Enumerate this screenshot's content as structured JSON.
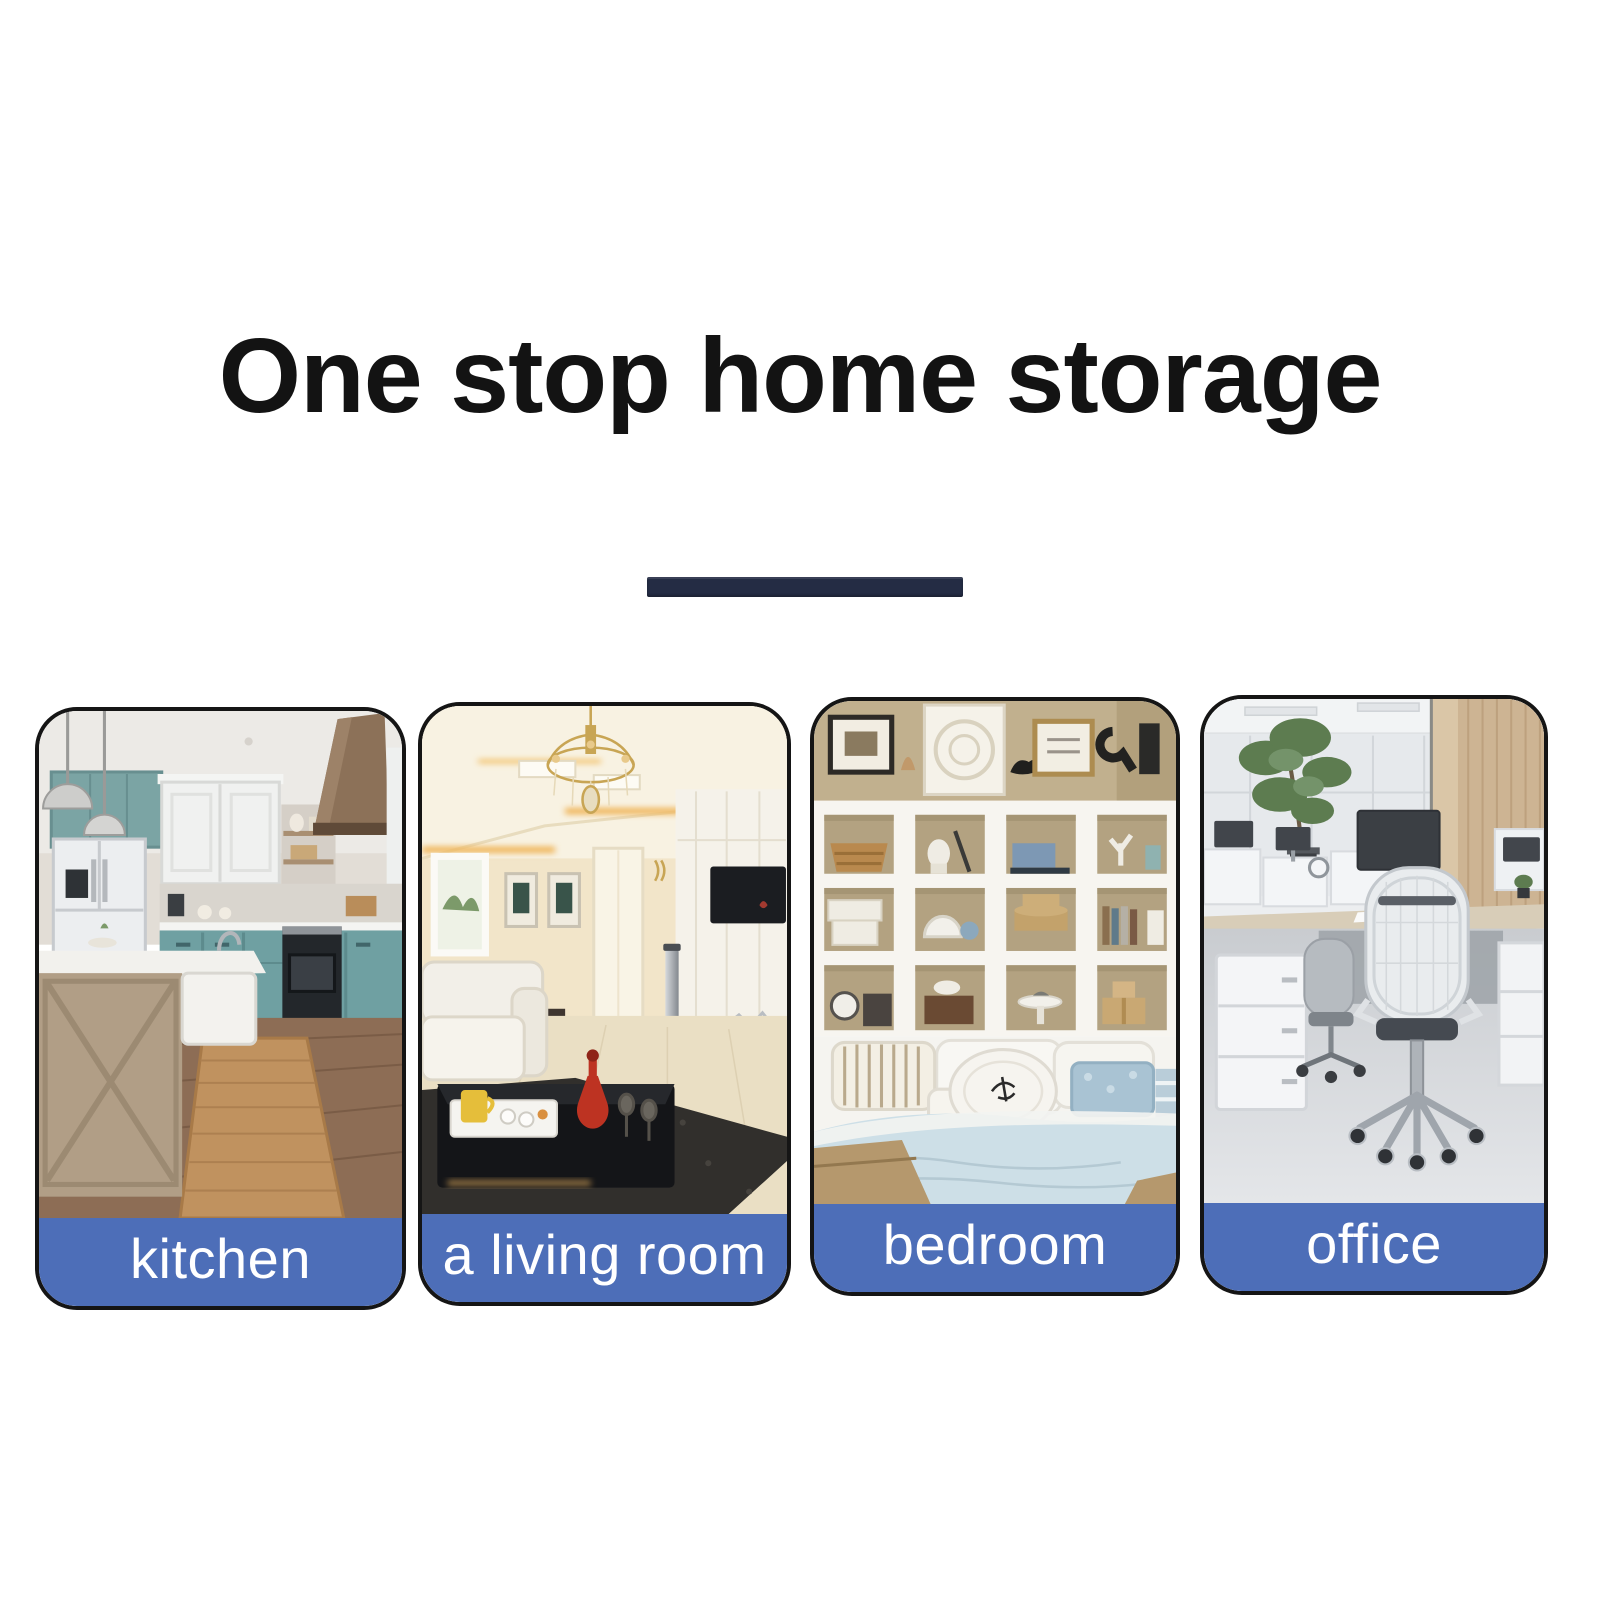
{
  "page": {
    "title": "One stop home storage",
    "background_color": "#ffffff",
    "title_color": "#131313",
    "divider_color": "#242c44"
  },
  "cards": [
    {
      "id": "kitchen",
      "label": "kitchen"
    },
    {
      "id": "living-room",
      "label": "a living room"
    },
    {
      "id": "bedroom",
      "label": "bedroom"
    },
    {
      "id": "office",
      "label": "office"
    }
  ],
  "style": {
    "label_band_color": "#4d6eb8",
    "label_text_color": "#ffffff",
    "card_border_color": "#151515"
  }
}
